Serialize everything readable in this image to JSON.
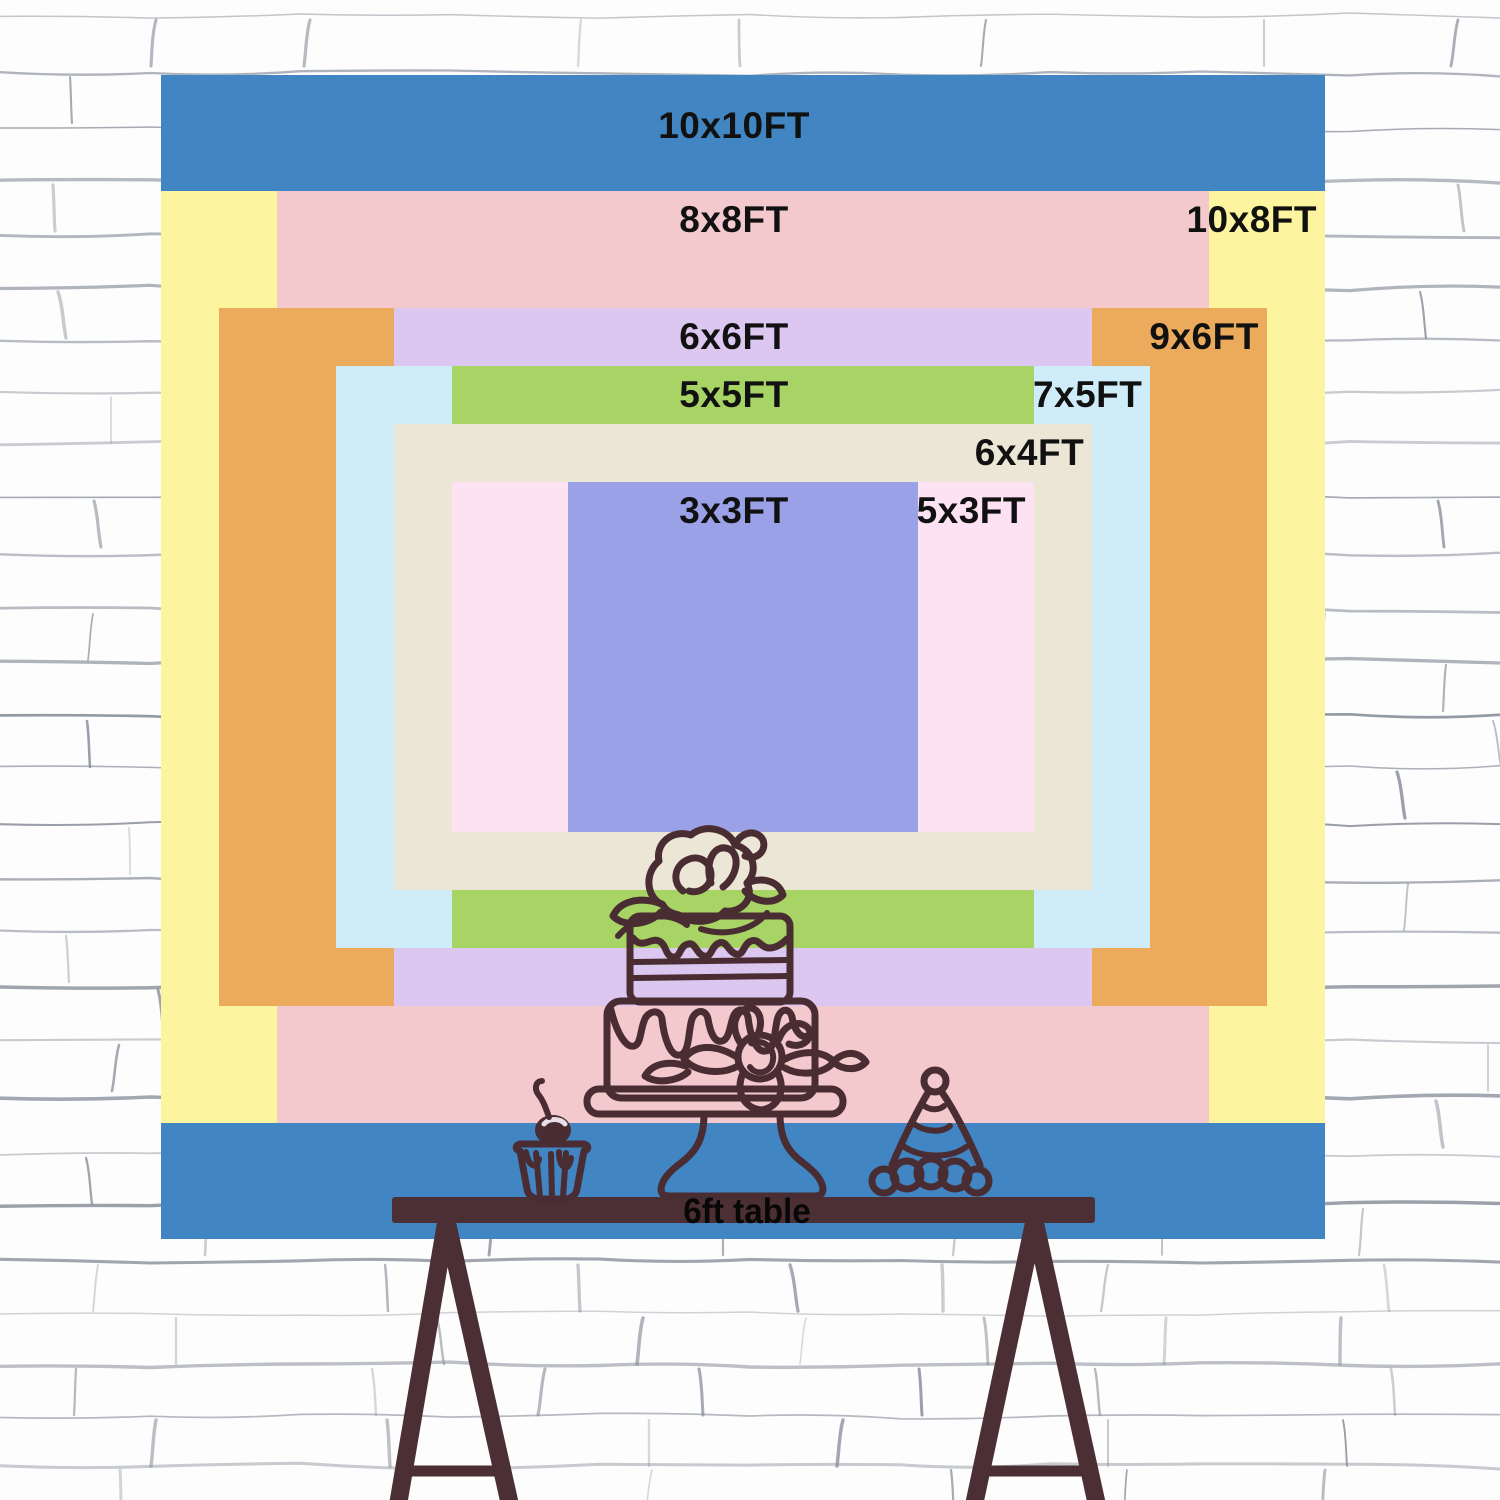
{
  "chart_data": {
    "type": "size-comparison",
    "unit": "FT",
    "scale_px_per_ft": 116.4,
    "center_px": {
      "x": 743,
      "y": 657
    },
    "label_color": "#111111",
    "sizes": [
      {
        "id": "10x10",
        "label": "10x10FT",
        "width_ft": 10,
        "height_ft": 10,
        "color": "#4285c3",
        "label_placement": "center"
      },
      {
        "id": "10x8",
        "label": "10x8FT",
        "width_ft": 10,
        "height_ft": 8,
        "color": "#fcf49e",
        "label_placement": "right"
      },
      {
        "id": "8x8",
        "label": "8x8FT",
        "width_ft": 8,
        "height_ft": 8,
        "color": "#f4c9cd",
        "label_placement": "center"
      },
      {
        "id": "9x6",
        "label": "9x6FT",
        "width_ft": 9,
        "height_ft": 6,
        "color": "#ecaa5c",
        "label_placement": "right"
      },
      {
        "id": "6x6",
        "label": "6x6FT",
        "width_ft": 6,
        "height_ft": 6,
        "color": "#dcc7f1",
        "label_placement": "center"
      },
      {
        "id": "7x5",
        "label": "7x5FT",
        "width_ft": 7,
        "height_ft": 5,
        "color": "#cfedf8",
        "label_placement": "right"
      },
      {
        "id": "5x5",
        "label": "5x5FT",
        "width_ft": 5,
        "height_ft": 5,
        "color": "#a7d464",
        "label_placement": "center"
      },
      {
        "id": "6x4",
        "label": "6x4FT",
        "width_ft": 6,
        "height_ft": 4,
        "color": "#ebe6d5",
        "label_placement": "right"
      },
      {
        "id": "5x3",
        "label": "5x3FT",
        "width_ft": 5,
        "height_ft": 3,
        "color": "#fde2f3",
        "label_placement": "right"
      },
      {
        "id": "3x3",
        "label": "3x3FT",
        "width_ft": 3,
        "height_ft": 3,
        "color": "#9aa1e6",
        "label_placement": "center"
      }
    ]
  },
  "table": {
    "label": "6ft table",
    "color": "#4b2f35"
  },
  "illustration": {
    "stroke_color": "#4a2d33",
    "items": [
      "tiered-cake-on-stand",
      "cupcake-with-cherry",
      "party-hat"
    ]
  },
  "wall": {
    "background": "#fdfdfd",
    "mortar_line_color": "#878d99"
  }
}
